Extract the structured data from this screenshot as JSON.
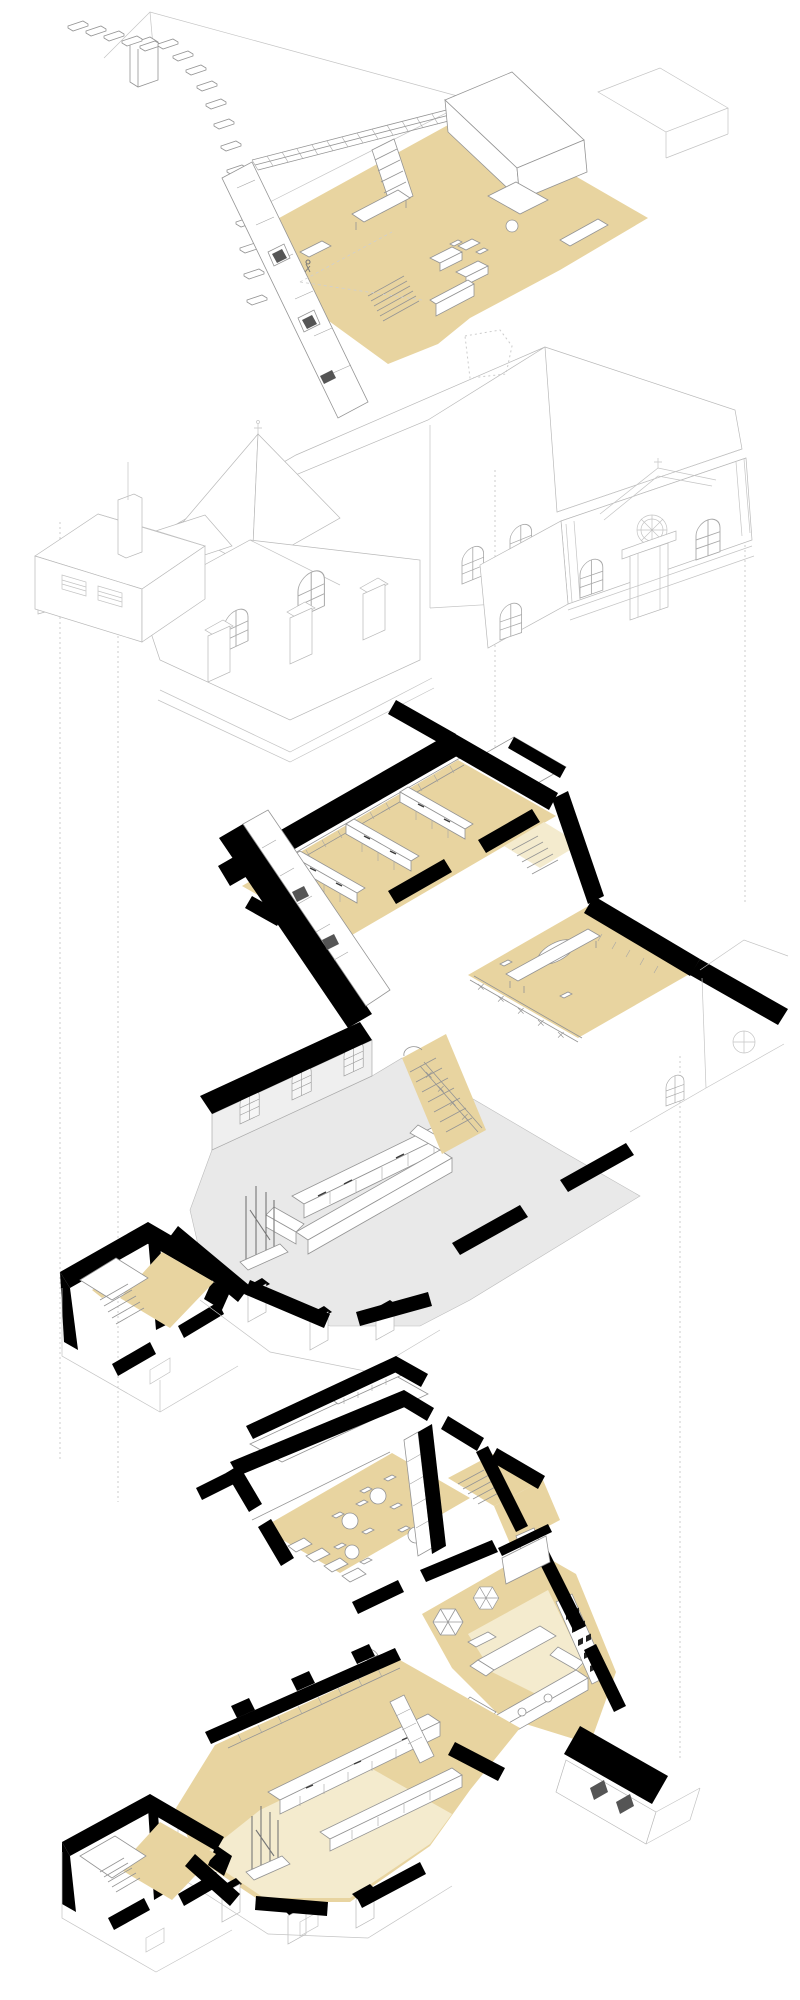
{
  "page": {
    "background": "#ffffff",
    "width": 800,
    "height": 2000
  },
  "palette": {
    "floor_tan": "#e8d4a0",
    "floor_tan_light": "#f4ebce",
    "floor_gray": "#e9e9e9",
    "wall_gray_face": "#efefef",
    "wall_black": "#000000",
    "line_strong": "#949494",
    "line_light": "#c4c4c4",
    "guide_dotted": "#cccccc",
    "book_dark": "#222222"
  },
  "drawing": {
    "type": "axonometric-exploded-view",
    "levels": [
      {
        "id": "attic-plan",
        "position": "top",
        "floor_color_key": "floor_tan"
      },
      {
        "id": "exterior-elevation",
        "position": "upper-middle"
      },
      {
        "id": "gallery-plan",
        "position": "lower-middle",
        "floor_color_key": "floor_tan",
        "hall_floor_color_key": "floor_gray"
      },
      {
        "id": "ground-plan",
        "position": "bottom",
        "floor_color_key": "floor_tan"
      }
    ],
    "guides": {
      "style": "dotted",
      "color_key": "guide_dotted"
    }
  }
}
